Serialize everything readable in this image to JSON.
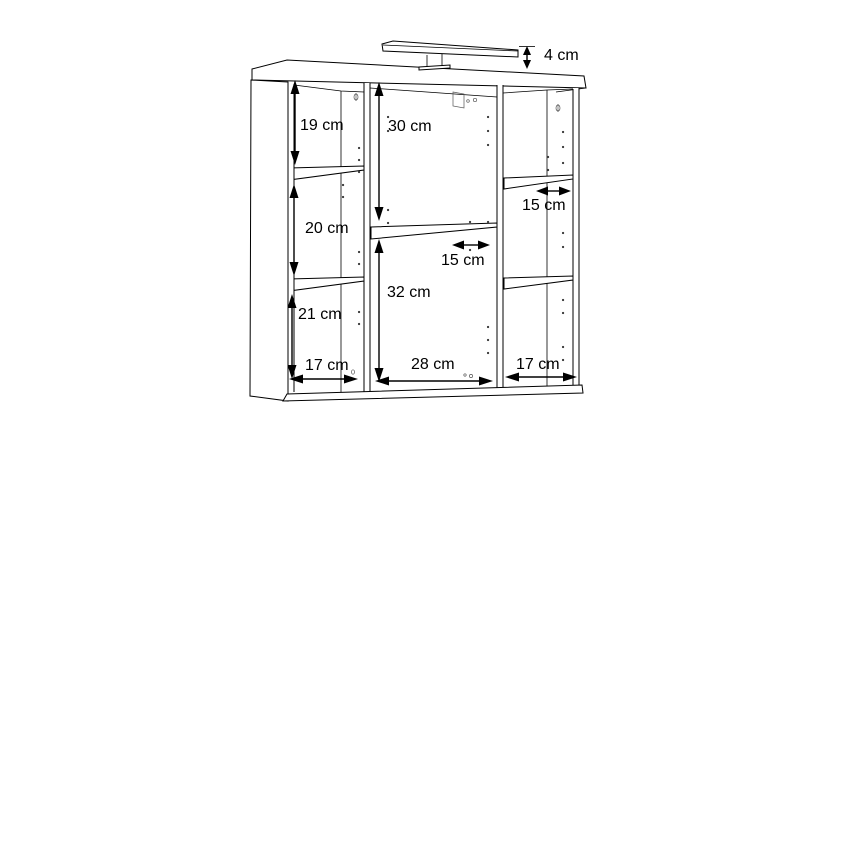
{
  "diagram": {
    "kind": "furniture dimension line drawing",
    "subject": "bathroom mirror wall cabinet with top light, three sections and shelves",
    "background_color": "#ffffff",
    "line_color": "#000000",
    "labels": {
      "light_height": "4 cm",
      "left_top_gap": "19 cm",
      "left_middle_gap": "20 cm",
      "left_bottom_gap": "21 cm",
      "center_top_gap": "30 cm",
      "center_bottom_gap": "32 cm",
      "center_shelf_depth": "15 cm",
      "right_shelf_depth": "15 cm",
      "left_width": "17 cm",
      "center_width": "28 cm",
      "right_width": "17 cm"
    }
  }
}
